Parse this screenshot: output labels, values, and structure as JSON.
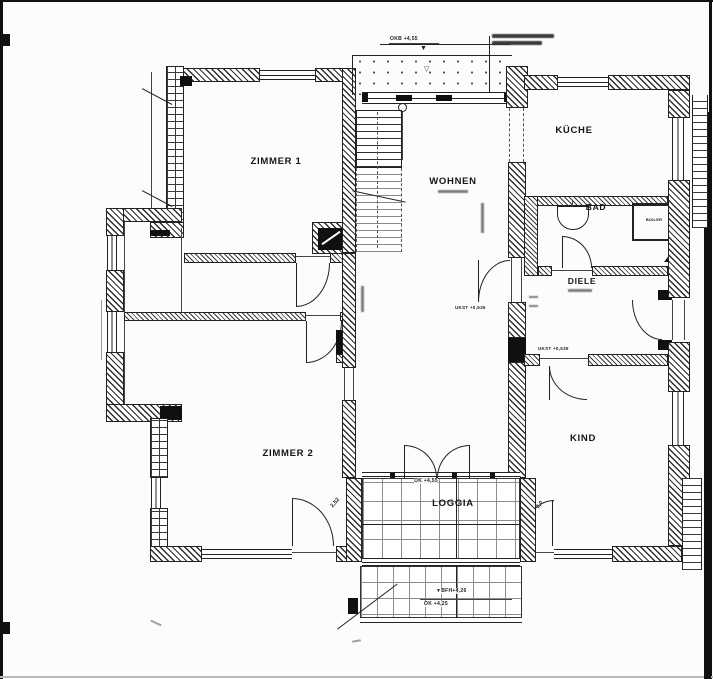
{
  "document": {
    "kind_label": "scanned architectural floor plan",
    "paper_color": "#fcfcfa",
    "ink_color": "#222222"
  },
  "rooms": {
    "zimmer1": "ZIMMER 1",
    "zimmer2": "ZIMMER 2",
    "wohnen": "WOHNEN",
    "kueche": "KÜCHE",
    "bad": "BAD",
    "diele": "DIELE",
    "kind": "KIND",
    "loggia": "LOGGIA",
    "boiler": "BOILER"
  },
  "annotations": {
    "okb_top": "OKB +4,55",
    "loggia_level": "OK +4,55",
    "bfh": "BFH+4,26",
    "ok_lower": "OK +4,25",
    "ukst_wohnen": "UKST +0,535",
    "ukst_kind": "UKST +0,535",
    "door_width_left": "2,52",
    "door_width_right": "2,0"
  },
  "icons": {
    "level_marker": "▼",
    "terrace_marker": "▽"
  }
}
